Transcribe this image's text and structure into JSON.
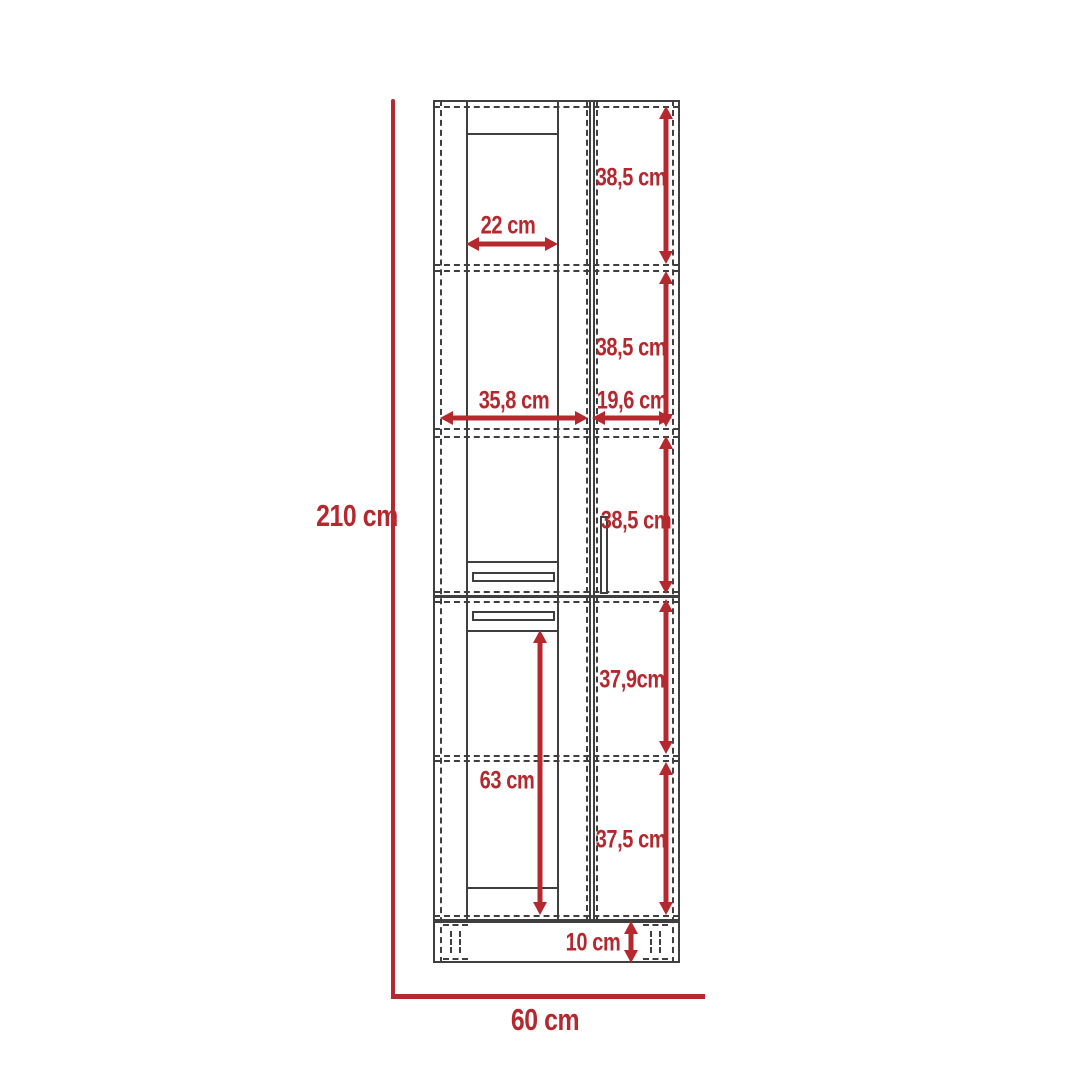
{
  "diagram": {
    "type": "furniture-dimension-drawing",
    "colors": {
      "accent": "#b4282e",
      "line": "#3f3f3f",
      "background": "#ffffff"
    },
    "dimensions": {
      "total_height": "210 cm",
      "total_width": "60 cm",
      "top_door_width": "22 cm",
      "left_section_width": "35,8 cm",
      "right_section_width": "19,6 cm",
      "compartment_1_height": "38,5 cm",
      "compartment_2_height": "38,5 cm",
      "compartment_3_height": "38,5 cm",
      "compartment_4_height": "37,9cm",
      "compartment_5_height": "37,5 cm",
      "lower_door_height": "63 cm",
      "plinth_height": "10 cm"
    }
  }
}
